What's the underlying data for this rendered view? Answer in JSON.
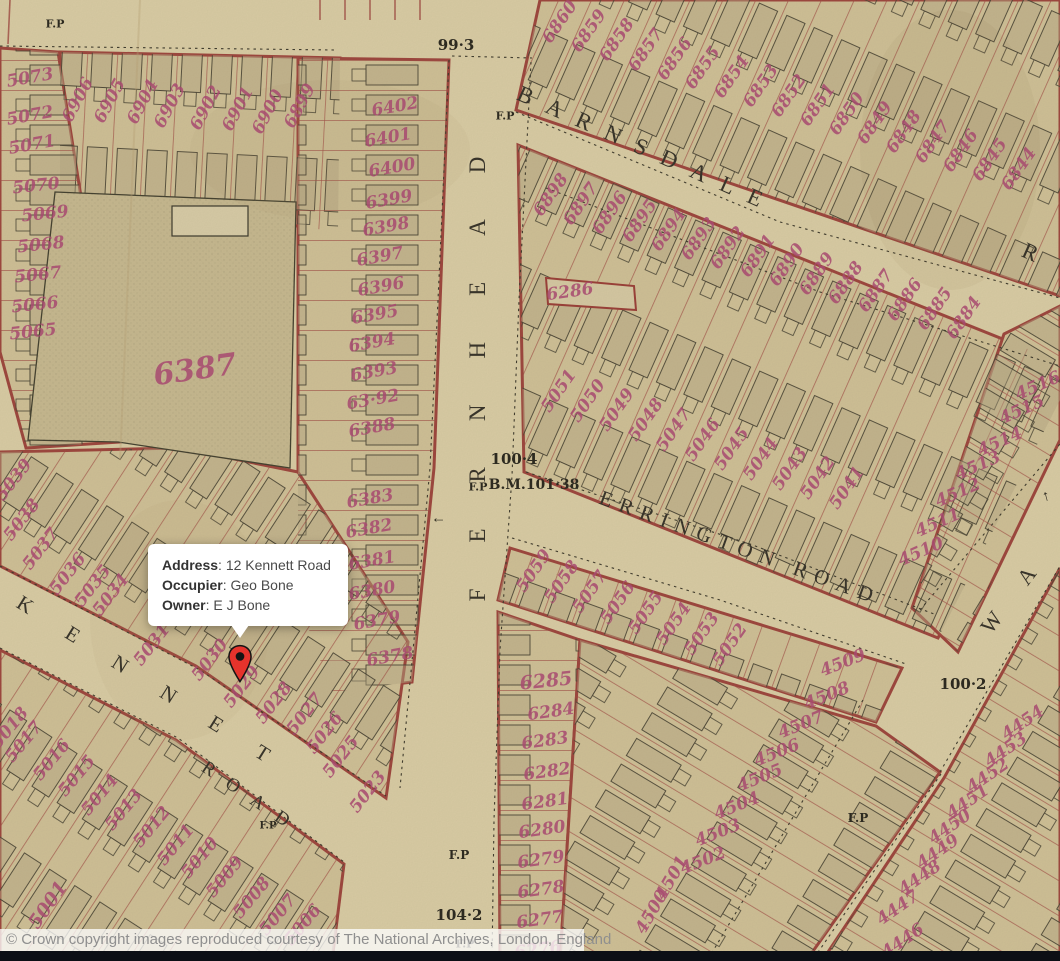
{
  "tooltip": {
    "rows": [
      {
        "label": "Address",
        "value": "12 Kennett Road"
      },
      {
        "label": "Occupier",
        "value": "Geo Bone"
      },
      {
        "label": "Owner",
        "value": "E J Bone"
      }
    ]
  },
  "copyright": "© Crown copyright images reproduced courtesy of The National Archives, London, England",
  "colors": {
    "parchment": "#d9cca4",
    "block": "#cfc096",
    "plot_line_red": "#9a3e37",
    "plot_number_pink": "#a84a70",
    "map_ink": "#2d2a20",
    "pin_red": "#e5332c",
    "bottom_bar": "#0c0f15"
  },
  "map": {
    "streets": [
      {
        "text": "FERNHEAD",
        "x": 478,
        "y": 356,
        "rot": -90,
        "ls": 46,
        "size": 23
      },
      {
        "text": "BARNSDALE",
        "x": 647,
        "y": 150,
        "rot": 24,
        "ls": 16,
        "size": 23
      },
      {
        "text": "R",
        "x": 1031,
        "y": 253,
        "rot": 24,
        "ls": 2,
        "size": 23
      },
      {
        "text": "ERRINGTON ROAD",
        "x": 740,
        "y": 548,
        "rot": 20,
        "ls": 8,
        "size": 21
      },
      {
        "text": "KENNET",
        "x": 161,
        "y": 690,
        "rot": 32,
        "ls": 42,
        "size": 21
      },
      {
        "text": "ROAD",
        "x": 252,
        "y": 799,
        "rot": 34,
        "ls": 16,
        "size": 19
      },
      {
        "text": "W A",
        "x": 1014,
        "y": 593,
        "rot": -53,
        "ls": 18,
        "size": 22
      }
    ],
    "survey_labels": [
      [
        "99·3",
        456,
        45,
        15
      ],
      [
        "F.P",
        505,
        116,
        11
      ],
      [
        "F.P",
        55,
        24,
        11
      ],
      [
        "100·4",
        514,
        459,
        15
      ],
      [
        "F.P",
        478,
        487,
        11
      ],
      [
        "B.M.101·38",
        534,
        485,
        14
      ],
      [
        "104·2",
        459,
        915,
        15
      ],
      [
        "F.P",
        459,
        855,
        12
      ],
      [
        "F.P",
        465,
        944,
        11
      ],
      [
        "100·2",
        963,
        684,
        15
      ],
      [
        "F.P",
        858,
        818,
        12
      ],
      [
        "F.P",
        268,
        826,
        10
      ]
    ],
    "arrows": [
      {
        "x": 1046,
        "y": 496,
        "rot": -15
      },
      {
        "x": 438,
        "y": 520,
        "rot": -90
      }
    ],
    "plot_numbers": [
      [
        "5073",
        30,
        78,
        -10
      ],
      [
        "5072",
        30,
        116,
        -10
      ],
      [
        "5071",
        32,
        145,
        -10
      ],
      [
        "5070",
        36,
        186,
        -6
      ],
      [
        "5069",
        45,
        214,
        -6
      ],
      [
        "5068",
        41,
        245,
        -6
      ],
      [
        "5067",
        38,
        275,
        -6
      ],
      [
        "5066",
        35,
        305,
        -6
      ],
      [
        "5065",
        33,
        332,
        -6
      ],
      [
        "6906",
        78,
        100,
        -62
      ],
      [
        "6905",
        110,
        101,
        -62
      ],
      [
        "6904",
        143,
        102,
        -62
      ],
      [
        "6903",
        170,
        106,
        -62
      ],
      [
        "6902",
        206,
        108,
        -62
      ],
      [
        "6901",
        238,
        109,
        -62
      ],
      [
        "6900",
        268,
        112,
        -62
      ],
      [
        "6899",
        300,
        106,
        -62
      ],
      [
        "6402",
        395,
        107,
        -10
      ],
      [
        "6401",
        388,
        138,
        -10
      ],
      [
        "6400",
        392,
        168,
        -10
      ],
      [
        "6399",
        389,
        200,
        -10
      ],
      [
        "6398",
        386,
        227,
        -10
      ],
      [
        "6397",
        380,
        257,
        -10
      ],
      [
        "6396",
        381,
        287,
        -10
      ],
      [
        "6395",
        375,
        315,
        -10
      ],
      [
        "6394",
        372,
        343,
        -10
      ],
      [
        "6393",
        374,
        372,
        -10
      ],
      [
        "63·92",
        373,
        400,
        -10
      ],
      [
        "6388",
        372,
        428,
        -10
      ],
      [
        "6383",
        370,
        499,
        -10
      ],
      [
        "6382",
        369,
        529,
        -10
      ],
      [
        "6381",
        372,
        561,
        -10
      ],
      [
        "6380",
        372,
        591,
        -10
      ],
      [
        "6379",
        377,
        621,
        -10
      ],
      [
        "6378",
        390,
        657,
        -10
      ],
      [
        "6387",
        195,
        370,
        -8,
        30
      ],
      [
        "6860",
        560,
        22,
        -55
      ],
      [
        "6859",
        589,
        31,
        -55
      ],
      [
        "6858",
        617,
        40,
        -55
      ],
      [
        "6857",
        646,
        50,
        -55
      ],
      [
        "6856",
        675,
        59,
        -55
      ],
      [
        "6855",
        703,
        68,
        -55
      ],
      [
        "6854",
        732,
        77,
        -55
      ],
      [
        "6853",
        761,
        86,
        -55
      ],
      [
        "6852",
        789,
        96,
        -55
      ],
      [
        "6851",
        818,
        105,
        -55
      ],
      [
        "6850",
        847,
        114,
        -55
      ],
      [
        "6849",
        875,
        123,
        -55
      ],
      [
        "6848",
        904,
        132,
        -55
      ],
      [
        "6847",
        933,
        142,
        -55
      ],
      [
        "6846",
        961,
        151,
        -55
      ],
      [
        "6845",
        990,
        160,
        -55
      ],
      [
        "6844",
        1019,
        169,
        -55
      ],
      [
        "6898",
        551,
        195,
        -55
      ],
      [
        "6897",
        581,
        204,
        -55
      ],
      [
        "6896",
        610,
        213,
        -55
      ],
      [
        "6895",
        640,
        221,
        -55
      ],
      [
        "6894",
        669,
        230,
        -55
      ],
      [
        "6893",
        699,
        239,
        -55
      ],
      [
        "6892",
        728,
        248,
        -55
      ],
      [
        "6891",
        758,
        256,
        -55
      ],
      [
        "6890",
        787,
        265,
        -55
      ],
      [
        "6889",
        817,
        274,
        -55
      ],
      [
        "6888",
        846,
        283,
        -55
      ],
      [
        "6887",
        876,
        291,
        -55
      ],
      [
        "6886",
        905,
        300,
        -55
      ],
      [
        "6885",
        935,
        309,
        -55
      ],
      [
        "6884",
        964,
        318,
        -55
      ],
      [
        "6286",
        570,
        292,
        -8
      ],
      [
        "5051",
        559,
        391,
        -55
      ],
      [
        "5050",
        588,
        401,
        -55
      ],
      [
        "5049",
        617,
        410,
        -55
      ],
      [
        "5048",
        646,
        420,
        -55
      ],
      [
        "5047",
        674,
        430,
        -55
      ],
      [
        "5046",
        703,
        440,
        -55
      ],
      [
        "5045",
        732,
        449,
        -55
      ],
      [
        "5044",
        761,
        459,
        -55
      ],
      [
        "5043",
        790,
        469,
        -55
      ],
      [
        "5042",
        818,
        478,
        -55
      ],
      [
        "5041",
        847,
        488,
        -55
      ],
      [
        "4516",
        1038,
        386,
        -24
      ],
      [
        "4515",
        1022,
        410,
        -24
      ],
      [
        "4514",
        1000,
        442,
        -24
      ],
      [
        "4513",
        978,
        466,
        -24
      ],
      [
        "4512",
        958,
        493,
        -24
      ],
      [
        "4511",
        938,
        523,
        -24
      ],
      [
        "4510",
        921,
        552,
        -24
      ],
      [
        "5059",
        534,
        571,
        -55
      ],
      [
        "5058",
        562,
        582,
        -55
      ],
      [
        "5057",
        590,
        592,
        -55
      ],
      [
        "5056",
        618,
        603,
        -55
      ],
      [
        "5055",
        646,
        613,
        -55
      ],
      [
        "5054",
        674,
        624,
        -55
      ],
      [
        "5053",
        702,
        634,
        -55
      ],
      [
        "5052",
        730,
        645,
        -55
      ],
      [
        "6285",
        546,
        681,
        -6,
        19
      ],
      [
        "6284",
        551,
        712,
        -8
      ],
      [
        "6283",
        545,
        741,
        -8
      ],
      [
        "6282",
        547,
        772,
        -8
      ],
      [
        "6281",
        545,
        802,
        -8
      ],
      [
        "6280",
        542,
        830,
        -8
      ],
      [
        "6279",
        541,
        860,
        -8
      ],
      [
        "6278",
        541,
        890,
        -8
      ],
      [
        "6277",
        540,
        920,
        -8
      ],
      [
        "6276",
        538,
        950,
        -8
      ],
      [
        "4509",
        843,
        663,
        -22
      ],
      [
        "4508",
        827,
        696,
        -22
      ],
      [
        "4507",
        801,
        725,
        -22
      ],
      [
        "4506",
        777,
        753,
        -22
      ],
      [
        "4505",
        760,
        778,
        -22
      ],
      [
        "4504",
        737,
        806,
        -22
      ],
      [
        "4503",
        718,
        833,
        -22
      ],
      [
        "4502",
        703,
        861,
        -22
      ],
      [
        "4501",
        672,
        878,
        -60
      ],
      [
        "4500",
        652,
        912,
        -60
      ],
      [
        "4454",
        1023,
        723,
        -35
      ],
      [
        "4453",
        1006,
        750,
        -35
      ],
      [
        "4452",
        988,
        776,
        -35
      ],
      [
        "4451",
        968,
        802,
        -35
      ],
      [
        "4450",
        950,
        827,
        -35
      ],
      [
        "4449",
        938,
        852,
        -35
      ],
      [
        "4448",
        920,
        878,
        -35
      ],
      [
        "4447",
        898,
        908,
        -35
      ],
      [
        "4446",
        903,
        941,
        -35
      ],
      [
        "5039",
        14,
        480,
        -52
      ],
      [
        "5038",
        22,
        520,
        -52
      ],
      [
        "5037",
        41,
        549,
        -52
      ],
      [
        "5036",
        68,
        574,
        -52
      ],
      [
        "5035",
        93,
        586,
        -52
      ],
      [
        "5034",
        111,
        595,
        -52
      ],
      [
        "5031",
        152,
        645,
        -52
      ],
      [
        "5030",
        210,
        660,
        -52
      ],
      [
        "5029",
        242,
        687,
        -52
      ],
      [
        "5028",
        274,
        703,
        -52
      ],
      [
        "5027",
        305,
        714,
        -52
      ],
      [
        "5026",
        325,
        733,
        -52
      ],
      [
        "5025",
        341,
        757,
        -52
      ],
      [
        "5023",
        368,
        792,
        -52
      ],
      [
        "5018",
        10,
        728,
        -50
      ],
      [
        "5017",
        24,
        742,
        -50
      ],
      [
        "5016",
        52,
        760,
        -50
      ],
      [
        "5015",
        77,
        776,
        -50
      ],
      [
        "5014",
        100,
        795,
        -50
      ],
      [
        "5013",
        124,
        810,
        -50
      ],
      [
        "5012",
        152,
        827,
        -50
      ],
      [
        "5011",
        176,
        845,
        -50
      ],
      [
        "5010",
        200,
        858,
        -50
      ],
      [
        "5009",
        225,
        877,
        -50
      ],
      [
        "5008",
        252,
        898,
        -50
      ],
      [
        "5007",
        278,
        915,
        -50
      ],
      [
        "5006",
        303,
        925,
        -50
      ],
      [
        "5001",
        48,
        905,
        -55,
        19
      ]
    ]
  }
}
